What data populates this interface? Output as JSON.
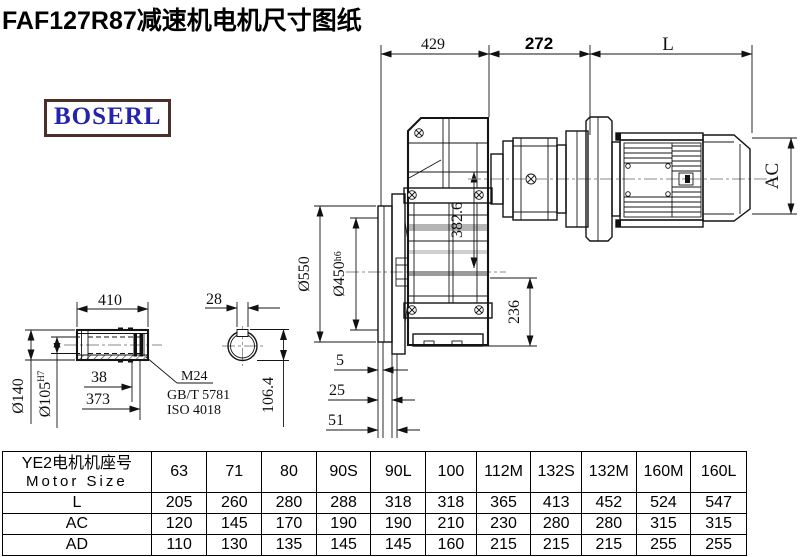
{
  "title": "FAF127R87减速机电机尺寸图纸",
  "logo": {
    "text": "BOSERL"
  },
  "drawing": {
    "dims": {
      "top_429": "429",
      "top_272": "272",
      "top_L": "L",
      "ac": "AC",
      "d550": "Ø550",
      "d450": "Ø450",
      "d450_tol": "h6",
      "d382_6": "382.6",
      "d236": "236",
      "b5": "5",
      "b25": "25",
      "b51": "51",
      "s410": "410",
      "s28": "28",
      "d140": "Ø140",
      "d105": "Ø105",
      "d105_tol": "H7",
      "s38": "38",
      "s373": "373",
      "thread": "M24",
      "std1": "GB/T 5781",
      "std2": "ISO 4018",
      "s106_4": "106.4"
    }
  },
  "table": {
    "header": {
      "line1": "YE2电机机座号",
      "line2": "Motor Size"
    },
    "columns": [
      "63",
      "71",
      "80",
      "90S",
      "90L",
      "100",
      "112M",
      "132S",
      "132M",
      "160M",
      "160L"
    ],
    "rows": [
      {
        "label": "L",
        "values": [
          "205",
          "260",
          "280",
          "288",
          "318",
          "318",
          "365",
          "413",
          "452",
          "524",
          "547"
        ]
      },
      {
        "label": "AC",
        "values": [
          "120",
          "145",
          "170",
          "190",
          "190",
          "210",
          "230",
          "280",
          "280",
          "315",
          "315"
        ]
      },
      {
        "label": "AD",
        "values": [
          "110",
          "130",
          "135",
          "145",
          "145",
          "160",
          "215",
          "215",
          "215",
          "255",
          "255"
        ]
      }
    ]
  }
}
